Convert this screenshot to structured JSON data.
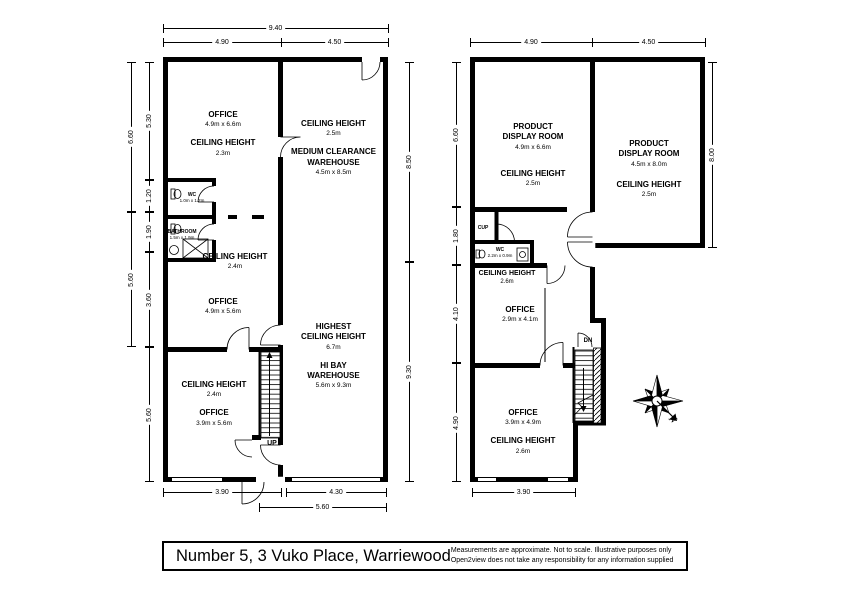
{
  "meta": {
    "title": "Number 5, 3 Vuko Place, Warriewood",
    "disclaimer_line1": "Measurements are approximate. Not to scale. Illustrative purposes only",
    "disclaimer_line2": "Open2view does not take any responsibility for any information supplied"
  },
  "compass": {
    "north_label": "N"
  },
  "ground_floor": {
    "dims": {
      "top_total": "9.40",
      "top_left": "4.90",
      "top_right": "4.50",
      "left_outer_top": "6.60",
      "left_outer_mid": "5.60",
      "left_inner_1": "5.30",
      "left_inner_2": "1.20",
      "left_inner_3": "1.90",
      "left_inner_4": "3.60",
      "left_inner_5": "5.60",
      "right_top": "8.50",
      "right_bottom": "9.30",
      "bottom_left": "3.90",
      "bottom_right": "4.30",
      "bottom_total": "5.60"
    },
    "rooms": {
      "office_top": {
        "name": "OFFICE",
        "size": "4.9m x 6.6m",
        "ch_label": "CEILING HEIGHT",
        "ch_value": "2.3m"
      },
      "warehouse_medium": {
        "ch_label": "CEILING HEIGHT",
        "ch_value": "2.5m",
        "name": "MEDIUM CLEARANCE\nWAREHOUSE",
        "size": "4.5m x 8.5m"
      },
      "wc": {
        "name": "WC",
        "size": "1.0m x 1.2m"
      },
      "bathroom": {
        "name": "BATHROOM",
        "size": "1.5m x 1.9m"
      },
      "office_mid_ch": {
        "ch_label": "CEILING HEIGHT",
        "ch_value": "2.4m"
      },
      "office_mid": {
        "name": "OFFICE",
        "size": "4.9m x 5.6m"
      },
      "hibay": {
        "highest_label": "HIGHEST\nCEILING HEIGHT",
        "highest_value": "6.7m",
        "name": "HI BAY\nWAREHOUSE",
        "size": "5.6m x 9.3m"
      },
      "office_bottom": {
        "ch_label": "CEILING HEIGHT",
        "ch_value": "2.4m",
        "name": "OFFICE",
        "size": "3.9m x 5.6m"
      },
      "stairs_label": "UP"
    }
  },
  "first_floor": {
    "dims": {
      "top_left": "4.90",
      "top_right": "4.50",
      "left_1": "6.60",
      "left_2": "1.80",
      "left_3": "4.10",
      "left_4": "4.90",
      "right": "8.00",
      "bottom": "3.90"
    },
    "rooms": {
      "display_left": {
        "name": "PRODUCT\nDISPLAY ROOM",
        "size": "4.9m x 6.6m",
        "ch_label": "CEILING HEIGHT",
        "ch_value": "2.5m"
      },
      "display_right": {
        "name": "PRODUCT\nDISPLAY ROOM",
        "size": "4.5m x 8.0m",
        "ch_label": "CEILING HEIGHT",
        "ch_value": "2.5m"
      },
      "cup": {
        "name": "CUP"
      },
      "wc": {
        "name": "WC",
        "size": "2.2m x 0.9m"
      },
      "office_mid_ch": {
        "ch_label": "CEILING HEIGHT",
        "ch_value": "2.6m"
      },
      "office_mid": {
        "name": "OFFICE",
        "size": "2.9m x 4.1m"
      },
      "office_bottom": {
        "name": "OFFICE",
        "size": "3.9m x 4.9m",
        "ch_label": "CEILING HEIGHT",
        "ch_value": "2.6m"
      },
      "stairs_label": "DN"
    }
  }
}
